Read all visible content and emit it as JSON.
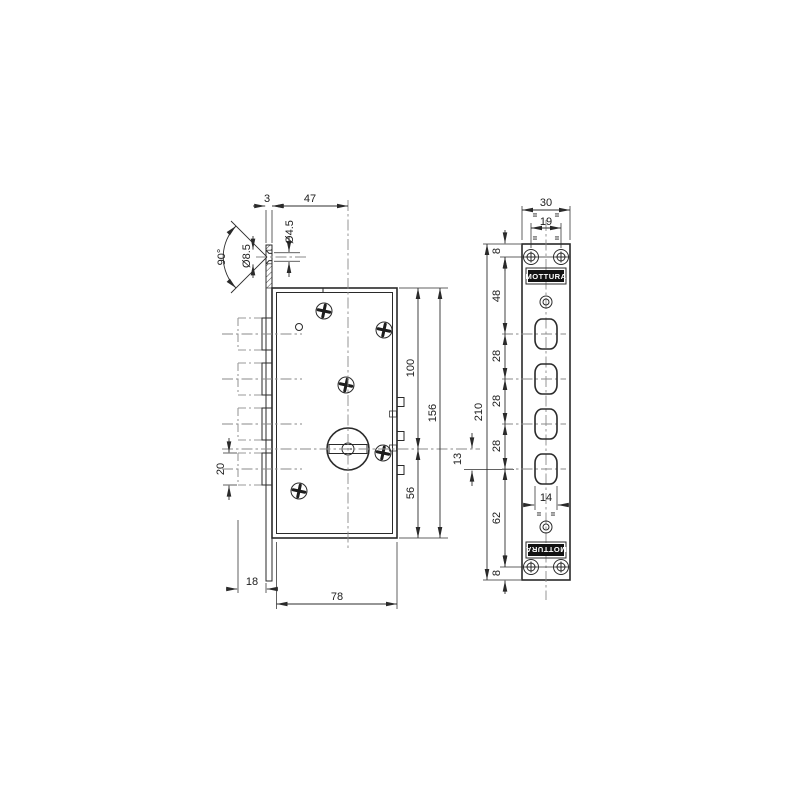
{
  "colors": {
    "background": "#ffffff",
    "line": "#2a2a2a",
    "centerline": "#8a8a8a",
    "brand_plate": "#121212",
    "brand_text": "#ffffff"
  },
  "side_view": {
    "dims": {
      "plate_thickness": "3",
      "backset": "47",
      "screw_hole_dia": "Ø4.5",
      "countersink_dia": "Ø8.5",
      "countersink_angle": "90°",
      "top_to_axis": "100",
      "case_height": "156",
      "axis_to_bottom": "56",
      "bolt_dia": "20",
      "bolt_throw": "18",
      "case_depth": "78",
      "axis_to_bolt_offset": "13"
    }
  },
  "front_view": {
    "brand_top": "MOTTURA",
    "brand_bottom": "MOTTURA",
    "equal_mark": "=",
    "dims": {
      "plate_width": "30",
      "screw_spacing": "19",
      "top_margin": "8",
      "screws_to_first_bolt": "48",
      "bolt_pitch_a": "28",
      "bolt_pitch_b": "28",
      "bolt_pitch_c": "28",
      "last_bolt_to_screws": "62",
      "bottom_margin": "8",
      "plate_height": "210",
      "bolt_slot_width": "14"
    }
  }
}
